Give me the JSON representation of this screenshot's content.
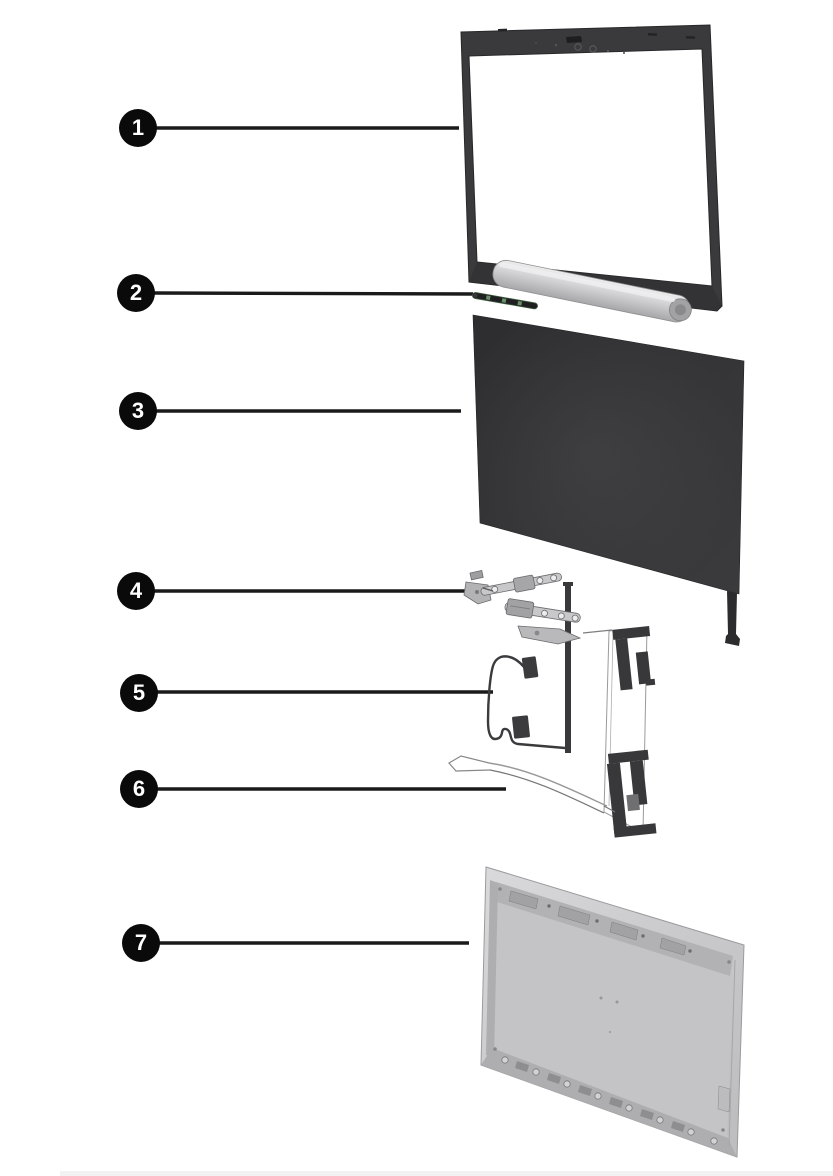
{
  "callouts": [
    {
      "number": "1",
      "part": "display-bezel"
    },
    {
      "number": "2",
      "part": "sensor-board"
    },
    {
      "number": "3",
      "part": "display-panel"
    },
    {
      "number": "4",
      "part": "hinge-kit"
    },
    {
      "number": "5",
      "part": "display-camera-cable"
    },
    {
      "number": "6",
      "part": "wireless-antenna-kit"
    },
    {
      "number": "7",
      "part": "display-back-cover"
    }
  ],
  "colors": {
    "background": "#ffffff",
    "callout_background": "#0a0a0a",
    "callout_number": "#ffffff",
    "leader_line": "#1a1a1a",
    "bezel_dark": "#3a3a3c",
    "panel_dark": "#333335",
    "hinge_metal": "#c6c6c8",
    "silver_bar": "#d9d9db",
    "antenna_dark": "#38383a",
    "back_cover": "#c6c6c8"
  }
}
